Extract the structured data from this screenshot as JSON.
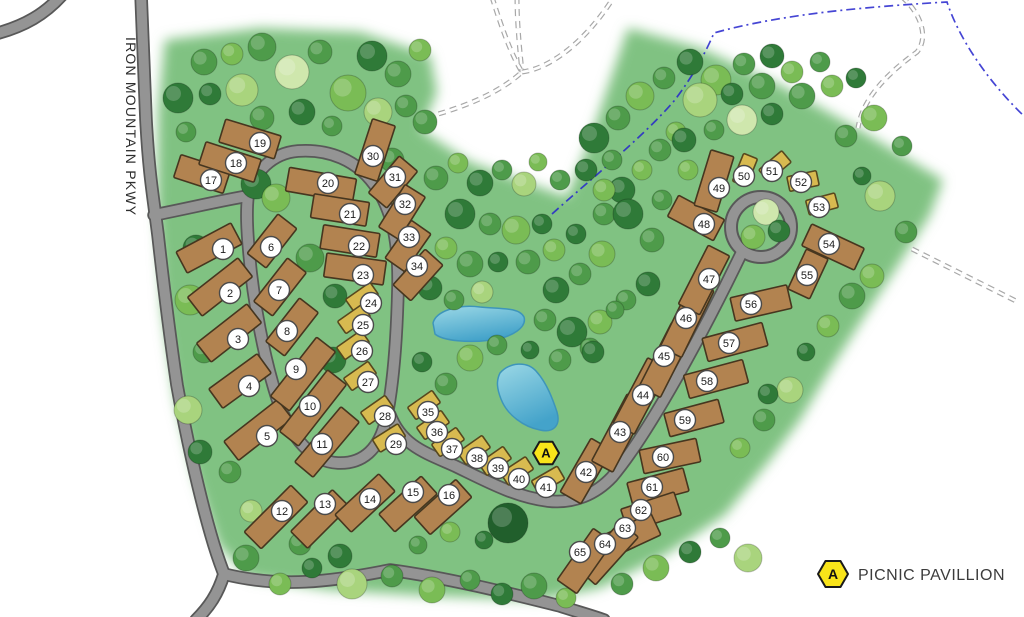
{
  "map": {
    "road_label": "IRON MOUNTAIN PKWY",
    "legend": {
      "symbol": "A",
      "label": "PICNIC PAVILLION"
    },
    "pavilion_marker": {
      "symbol": "A",
      "x": 546,
      "y": 453
    },
    "colors": {
      "grass": "#80c282",
      "road_fill": "#949494",
      "road_casing": "#585858",
      "site_standard_fill": "#b28350",
      "site_standard_stroke": "#46361f",
      "site_small_fill": "#d8ba50",
      "site_small_stroke": "#57481e",
      "pond_light": "#9bd8e6",
      "pond_deep": "#44a3ca",
      "stream_blue": "#2424cc",
      "marker_yellow": "#f9e41a",
      "label_circle_fill": "#ffffff",
      "label_circle_stroke": "#4a4a4a",
      "label_text": "#1c1c1c"
    },
    "site_fields": [
      "number",
      "cx",
      "cy",
      "angle_deg",
      "size_type_0std_1small",
      "label_x",
      "label_y",
      "length"
    ],
    "sites": [
      [
        1,
        209,
        248,
        -28,
        0,
        223,
        249,
        62
      ],
      [
        2,
        220,
        287,
        -38,
        0,
        230,
        293,
        64
      ],
      [
        3,
        229,
        333,
        -38,
        0,
        238,
        339,
        64
      ],
      [
        4,
        240,
        381,
        -36,
        0,
        249,
        386,
        60
      ],
      [
        5,
        258,
        430,
        -38,
        0,
        267,
        436,
        68
      ],
      [
        6,
        272,
        241,
        -52,
        0,
        271,
        247,
        50
      ],
      [
        7,
        280,
        287,
        -52,
        0,
        279,
        290,
        55
      ],
      [
        8,
        292,
        327,
        -52,
        0,
        287,
        331,
        55
      ],
      [
        9,
        303,
        374,
        -52,
        0,
        296,
        369,
        75
      ],
      [
        10,
        313,
        408,
        -52,
        0,
        310,
        406,
        78
      ],
      [
        11,
        327,
        442,
        -50,
        0,
        322,
        444,
        72
      ],
      [
        12,
        276,
        517,
        -45,
        0,
        282,
        511,
        66
      ],
      [
        13,
        320,
        519,
        -45,
        0,
        325,
        504,
        59
      ],
      [
        14,
        365,
        503,
        -43,
        0,
        370,
        499,
        60
      ],
      [
        15,
        408,
        504,
        -42,
        0,
        413,
        492,
        57
      ],
      [
        16,
        443,
        507,
        -42,
        0,
        449,
        495,
        56
      ],
      [
        17,
        202,
        174,
        18,
        0,
        211,
        180,
        52
      ],
      [
        18,
        230,
        162,
        18,
        0,
        236,
        163,
        58
      ],
      [
        19,
        250,
        139,
        17,
        0,
        260,
        143,
        58
      ],
      [
        20,
        321,
        185,
        10,
        0,
        328,
        183,
        68
      ],
      [
        21,
        340,
        210,
        9,
        0,
        350,
        214,
        56
      ],
      [
        22,
        350,
        241,
        9,
        0,
        359,
        246,
        57
      ],
      [
        23,
        355,
        269,
        8,
        0,
        363,
        275,
        60
      ],
      [
        24,
        362,
        297,
        -35,
        1,
        371,
        303,
        30
      ],
      [
        25,
        354,
        319,
        -35,
        1,
        363,
        325,
        30
      ],
      [
        26,
        353,
        345,
        -35,
        1,
        362,
        351,
        30
      ],
      [
        27,
        360,
        376,
        -35,
        1,
        368,
        382,
        30
      ],
      [
        28,
        377,
        410,
        -35,
        1,
        385,
        416,
        30
      ],
      [
        29,
        389,
        438,
        -32,
        1,
        396,
        444,
        30
      ],
      [
        30,
        375,
        150,
        -72,
        0,
        373,
        156,
        58
      ],
      [
        31,
        393,
        182,
        -50,
        0,
        395,
        177,
        48
      ],
      [
        32,
        402,
        212,
        -58,
        0,
        405,
        204,
        50
      ],
      [
        33,
        408,
        246,
        -55,
        0,
        409,
        237,
        46
      ],
      [
        34,
        418,
        275,
        -48,
        0,
        417,
        266,
        48
      ],
      [
        35,
        424,
        405,
        -35,
        1,
        428,
        412,
        30
      ],
      [
        36,
        433,
        425,
        -35,
        1,
        437,
        432,
        30
      ],
      [
        37,
        448,
        442,
        -35,
        1,
        452,
        449,
        30
      ],
      [
        38,
        474,
        450,
        -35,
        1,
        477,
        458,
        30
      ],
      [
        39,
        495,
        461,
        -35,
        1,
        498,
        468,
        30
      ],
      [
        40,
        517,
        471,
        -33,
        1,
        519,
        479,
        30
      ],
      [
        41,
        548,
        480,
        -30,
        1,
        546,
        487,
        30
      ],
      [
        42,
        586,
        471,
        -60,
        0,
        586,
        472,
        62
      ],
      [
        43,
        620,
        433,
        -62,
        0,
        620,
        432,
        76
      ],
      [
        44,
        641,
        396,
        -62,
        0,
        643,
        395,
        74
      ],
      [
        45,
        666,
        360,
        -63,
        0,
        664,
        356,
        72
      ],
      [
        46,
        687,
        319,
        -64,
        0,
        686,
        318,
        74
      ],
      [
        47,
        704,
        280,
        -63,
        0,
        709,
        279,
        66
      ],
      [
        48,
        696,
        218,
        28,
        0,
        704,
        224,
        52
      ],
      [
        49,
        714,
        181,
        -73,
        0,
        719,
        188,
        58
      ],
      [
        50,
        745,
        170,
        -68,
        1,
        744,
        176,
        30
      ],
      [
        51,
        775,
        166,
        -40,
        1,
        772,
        171,
        30
      ],
      [
        52,
        803,
        181,
        -12,
        1,
        801,
        182,
        30
      ],
      [
        53,
        822,
        204,
        -15,
        1,
        819,
        207,
        30
      ],
      [
        54,
        833,
        247,
        25,
        0,
        829,
        244,
        58
      ],
      [
        55,
        808,
        274,
        -65,
        0,
        807,
        275,
        44
      ],
      [
        56,
        761,
        303,
        -13,
        0,
        751,
        304,
        58
      ],
      [
        57,
        735,
        342,
        -15,
        0,
        729,
        343,
        62
      ],
      [
        58,
        716,
        379,
        -15,
        0,
        707,
        381,
        61
      ],
      [
        59,
        694,
        418,
        -15,
        0,
        685,
        420,
        56
      ],
      [
        60,
        670,
        456,
        -12,
        0,
        663,
        457,
        58
      ],
      [
        61,
        658,
        487,
        -15,
        0,
        652,
        487,
        58
      ],
      [
        62,
        651,
        512,
        -18,
        0,
        641,
        510,
        56
      ],
      [
        63,
        630,
        536,
        -25,
        0,
        625,
        528,
        57
      ],
      [
        64,
        608,
        553,
        -48,
        0,
        605,
        544,
        64
      ],
      [
        65,
        585,
        561,
        -55,
        0,
        580,
        552,
        63
      ]
    ],
    "tree_fields": [
      "x",
      "y",
      "r",
      "color_index"
    ],
    "tree_colors": [
      "#215f2c",
      "#2f7a38",
      "#4e9b4a",
      "#7abc55",
      "#a9d47d",
      "#cfe7ad"
    ],
    "trees": [
      [
        178,
        98,
        15,
        1
      ],
      [
        204,
        62,
        13,
        2
      ],
      [
        232,
        54,
        11,
        3
      ],
      [
        262,
        47,
        14,
        2
      ],
      [
        292,
        72,
        17,
        5
      ],
      [
        320,
        52,
        12,
        2
      ],
      [
        348,
        93,
        18,
        3
      ],
      [
        372,
        56,
        15,
        1
      ],
      [
        398,
        74,
        13,
        2
      ],
      [
        420,
        50,
        11,
        3
      ],
      [
        210,
        94,
        11,
        1
      ],
      [
        242,
        90,
        16,
        4
      ],
      [
        302,
        112,
        13,
        1
      ],
      [
        332,
        126,
        10,
        2
      ],
      [
        262,
        118,
        12,
        2
      ],
      [
        378,
        112,
        14,
        4
      ],
      [
        406,
        106,
        11,
        2
      ],
      [
        186,
        132,
        10,
        2
      ],
      [
        425,
        122,
        12,
        2
      ],
      [
        392,
        160,
        12,
        2
      ],
      [
        196,
        248,
        13,
        1
      ],
      [
        190,
        300,
        15,
        3
      ],
      [
        204,
        352,
        11,
        2
      ],
      [
        188,
        410,
        14,
        4
      ],
      [
        200,
        452,
        12,
        1
      ],
      [
        230,
        472,
        11,
        2
      ],
      [
        256,
        184,
        15,
        1
      ],
      [
        276,
        198,
        14,
        3
      ],
      [
        310,
        258,
        14,
        2
      ],
      [
        335,
        296,
        12,
        1
      ],
      [
        333,
        360,
        13,
        1
      ],
      [
        436,
        178,
        12,
        2
      ],
      [
        458,
        163,
        10,
        3
      ],
      [
        480,
        183,
        13,
        1
      ],
      [
        502,
        170,
        10,
        2
      ],
      [
        524,
        184,
        12,
        4
      ],
      [
        460,
        214,
        15,
        1
      ],
      [
        490,
        224,
        11,
        2
      ],
      [
        516,
        230,
        14,
        3
      ],
      [
        542,
        224,
        10,
        1
      ],
      [
        446,
        248,
        11,
        3
      ],
      [
        470,
        264,
        13,
        2
      ],
      [
        498,
        262,
        10,
        1
      ],
      [
        528,
        262,
        12,
        2
      ],
      [
        554,
        250,
        11,
        3
      ],
      [
        430,
        288,
        12,
        1
      ],
      [
        454,
        300,
        10,
        2
      ],
      [
        482,
        292,
        11,
        4
      ],
      [
        556,
        290,
        13,
        1
      ],
      [
        580,
        274,
        11,
        2
      ],
      [
        602,
        254,
        13,
        3
      ],
      [
        576,
        234,
        10,
        1
      ],
      [
        604,
        214,
        11,
        2
      ],
      [
        622,
        190,
        13,
        1
      ],
      [
        642,
        170,
        10,
        3
      ],
      [
        612,
        160,
        10,
        2
      ],
      [
        586,
        170,
        11,
        1
      ],
      [
        560,
        180,
        10,
        2
      ],
      [
        538,
        162,
        9,
        3
      ],
      [
        660,
        150,
        11,
        2
      ],
      [
        676,
        132,
        10,
        3
      ],
      [
        545,
        320,
        11,
        2
      ],
      [
        572,
        332,
        15,
        1
      ],
      [
        600,
        322,
        12,
        3
      ],
      [
        626,
        300,
        10,
        2
      ],
      [
        648,
        284,
        12,
        1
      ],
      [
        470,
        358,
        13,
        3
      ],
      [
        446,
        384,
        11,
        2
      ],
      [
        422,
        362,
        10,
        1
      ],
      [
        497,
        345,
        10,
        2
      ],
      [
        530,
        350,
        9,
        1
      ],
      [
        560,
        360,
        11,
        2
      ],
      [
        590,
        348,
        10,
        2
      ],
      [
        593,
        352,
        11,
        1
      ],
      [
        615,
        310,
        9,
        2
      ],
      [
        594,
        138,
        15,
        1
      ],
      [
        618,
        118,
        12,
        2
      ],
      [
        640,
        96,
        14,
        3
      ],
      [
        664,
        78,
        11,
        2
      ],
      [
        690,
        62,
        13,
        1
      ],
      [
        716,
        80,
        15,
        3
      ],
      [
        744,
        64,
        11,
        2
      ],
      [
        772,
        56,
        12,
        1
      ],
      [
        700,
        100,
        17,
        4
      ],
      [
        732,
        94,
        11,
        1
      ],
      [
        762,
        86,
        13,
        2
      ],
      [
        792,
        72,
        11,
        3
      ],
      [
        820,
        62,
        10,
        2
      ],
      [
        684,
        140,
        12,
        1
      ],
      [
        714,
        130,
        10,
        2
      ],
      [
        742,
        120,
        15,
        5
      ],
      [
        772,
        114,
        11,
        1
      ],
      [
        802,
        96,
        13,
        2
      ],
      [
        832,
        86,
        11,
        3
      ],
      [
        856,
        78,
        10,
        1
      ],
      [
        628,
        214,
        15,
        1
      ],
      [
        652,
        240,
        12,
        2
      ],
      [
        604,
        190,
        11,
        3
      ],
      [
        662,
        200,
        10,
        2
      ],
      [
        688,
        170,
        10,
        3
      ],
      [
        766,
        212,
        13,
        5
      ],
      [
        753,
        237,
        12,
        3
      ],
      [
        779,
        231,
        11,
        1
      ],
      [
        874,
        118,
        13,
        3
      ],
      [
        902,
        146,
        10,
        2
      ],
      [
        880,
        196,
        15,
        4
      ],
      [
        906,
        232,
        11,
        2
      ],
      [
        872,
        276,
        12,
        3
      ],
      [
        846,
        136,
        11,
        2
      ],
      [
        862,
        176,
        9,
        1
      ],
      [
        852,
        296,
        13,
        2
      ],
      [
        828,
        326,
        11,
        3
      ],
      [
        806,
        352,
        9,
        1
      ],
      [
        790,
        390,
        13,
        4
      ],
      [
        764,
        420,
        11,
        2
      ],
      [
        740,
        448,
        10,
        3
      ],
      [
        768,
        394,
        10,
        1
      ],
      [
        246,
        558,
        13,
        2
      ],
      [
        280,
        584,
        11,
        3
      ],
      [
        312,
        568,
        10,
        1
      ],
      [
        352,
        584,
        15,
        4
      ],
      [
        392,
        576,
        11,
        2
      ],
      [
        432,
        590,
        13,
        3
      ],
      [
        470,
        580,
        10,
        2
      ],
      [
        502,
        594,
        11,
        1
      ],
      [
        508,
        523,
        20,
        0
      ],
      [
        534,
        586,
        13,
        2
      ],
      [
        566,
        598,
        10,
        3
      ],
      [
        622,
        584,
        11,
        2
      ],
      [
        656,
        568,
        13,
        3
      ],
      [
        690,
        552,
        11,
        1
      ],
      [
        720,
        538,
        10,
        2
      ],
      [
        748,
        558,
        14,
        4
      ],
      [
        300,
        544,
        11,
        2
      ],
      [
        340,
        556,
        12,
        1
      ],
      [
        418,
        545,
        9,
        2
      ],
      [
        450,
        532,
        10,
        3
      ],
      [
        484,
        540,
        9,
        1
      ],
      [
        251,
        511,
        11,
        4
      ]
    ]
  }
}
